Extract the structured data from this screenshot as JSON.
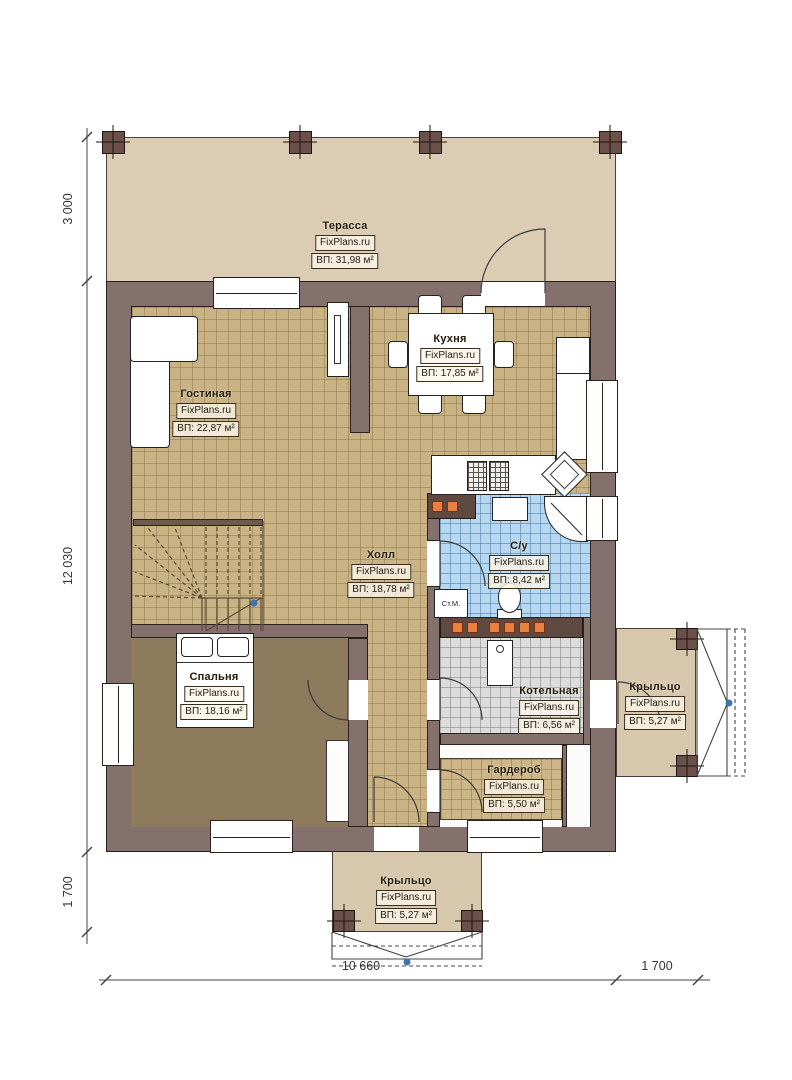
{
  "brand": "FixPlans.ru",
  "rooms": {
    "terrace": {
      "name": "Терасса",
      "area": "ВП: 31,98 м²"
    },
    "living": {
      "name": "Гостиная",
      "area": "ВП: 22,87 м²"
    },
    "kitchen": {
      "name": "Кухня",
      "area": "ВП: 17,85 м²"
    },
    "hall": {
      "name": "Холл",
      "area": "ВП: 18,78 м²"
    },
    "bathroom": {
      "name": "С/у",
      "area": "ВП: 8,42 м²"
    },
    "bedroom": {
      "name": "Спальня",
      "area": "ВП: 18,16 м²"
    },
    "boiler": {
      "name": "Котельная",
      "area": "ВП: 6,56 м²"
    },
    "wardrobe": {
      "name": "Гардероб",
      "area": "ВП: 5,50 м²"
    },
    "porch_right": {
      "name": "Крыльцо",
      "area": "ВП: 5,27 м²"
    },
    "porch_bottom": {
      "name": "Крыльцо",
      "area": "ВП: 5,27 м²"
    }
  },
  "annotations": {
    "washing_machine": "Ст.М."
  },
  "dimensions": {
    "left_top": "3 000",
    "left_middle": "12 030",
    "left_bottom": "1 700",
    "bottom_main": "10 660",
    "bottom_right": "1 700"
  },
  "colors": {
    "wall": "#84716e",
    "terrace": "#dbccb3",
    "floor_tile": "#c9b384",
    "bathroom_tile": "#b7d6ef",
    "boiler_tile": "#dcdcdc",
    "bedroom_floor": "#8e7a5d",
    "vent_orange": "#e8813f",
    "marker_blue": "#3f73ae"
  }
}
